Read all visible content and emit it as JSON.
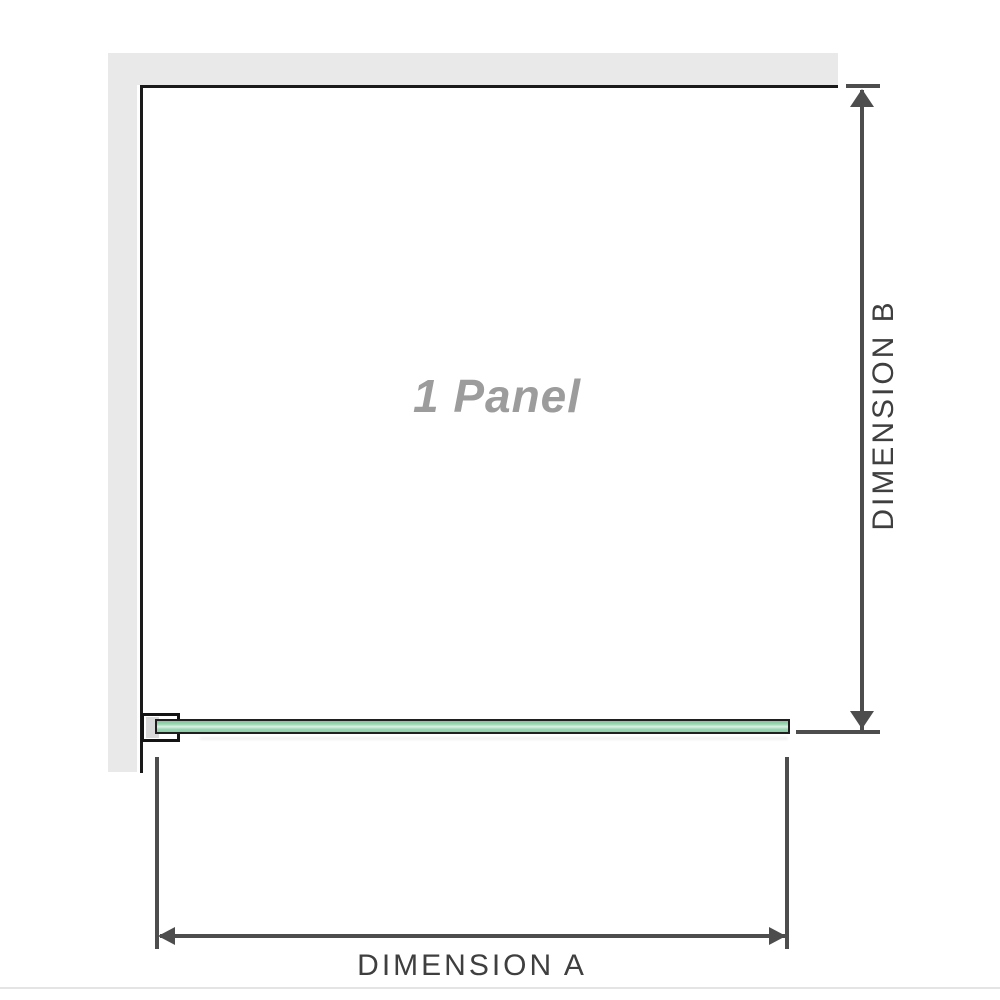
{
  "diagram": {
    "panel_label": "1 Panel",
    "dimension_a": {
      "label": "DIMENSION A"
    },
    "dimension_b": {
      "label": "DIMENSION B"
    }
  },
  "icons": {
    "dimension_a_arrows": "double-headed-horizontal-arrow",
    "dimension_b_arrows": "double-headed-vertical-arrow"
  },
  "colors": {
    "wall_gray": "#e9e9e9",
    "panel_outline": "#1a1a1a",
    "arrow_gray": "#4d4d4d",
    "glass_green": "#9ad7b3",
    "glass_highlight": "#ddf2e4",
    "glass_border": "#1f1f1f",
    "label_gray": "#9c9c9c",
    "dimension_text": "#3f3f3f",
    "divider": "#e4e4e4"
  }
}
